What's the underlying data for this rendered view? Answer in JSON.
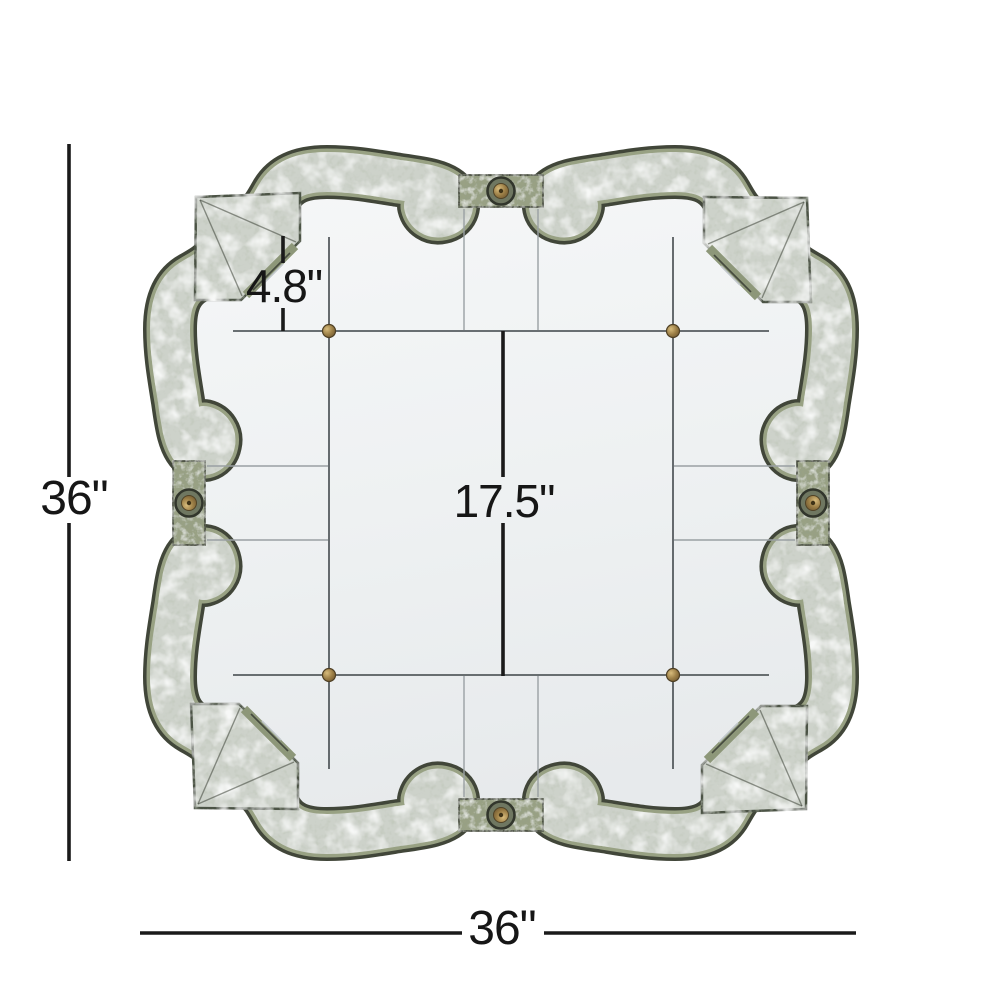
{
  "page": {
    "background": "#ffffff"
  },
  "diagram": {
    "subject": "quatrefoil-antique-wall-mirror-dimensions",
    "labels": {
      "height": "36\"",
      "width": "36\"",
      "top_panel": "4.8\"",
      "center": "17.5\""
    },
    "colors": {
      "dimension_line": "#1a1a1a",
      "frame_trim_dark": "#414639",
      "frame_moss_green": "#98a183",
      "frame_antiqued_silver": "#cdd2ca",
      "mirror_surface": "#eef1f2",
      "seam_line": "#565c5f",
      "brass_accent": "#9a7d45"
    }
  }
}
